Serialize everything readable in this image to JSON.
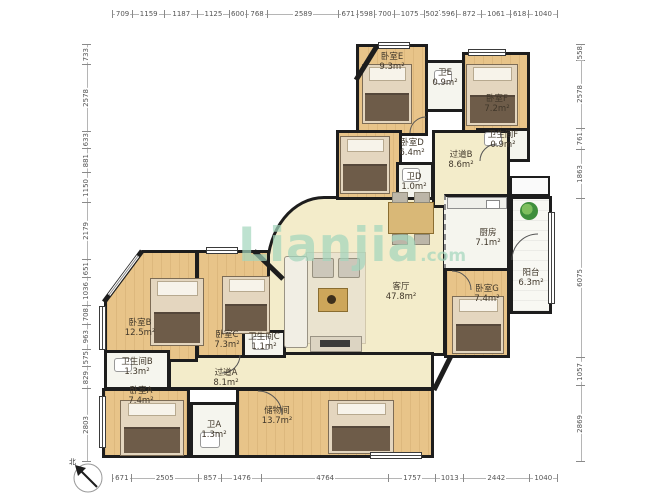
{
  "watermark": {
    "brand": "Lianjia",
    "suffix": ".com"
  },
  "compass": {
    "north_label": "北"
  },
  "colors": {
    "wall": "#1d1d1d",
    "wood_floor": "#e8c489",
    "public_floor": "#f3ecca",
    "wet_room_floor": "#f5f5ee",
    "watermark_green": "#a3d6bd"
  },
  "dimensions_mm": {
    "top": [
      709,
      1159,
      1187,
      1125,
      600,
      768,
      2589,
      671,
      598,
      700,
      1075,
      502,
      596,
      872,
      1061,
      618,
      1040
    ],
    "bottom": [
      671,
      2505,
      857,
      1476,
      4764,
      1757,
      1013,
      2442,
      1040
    ],
    "left": [
      733,
      2578,
      633,
      881,
      1150,
      2179,
      651,
      1036,
      708,
      963,
      575,
      829,
      2803
    ],
    "right": [
      558,
      2578,
      761,
      1863,
      6075,
      1057,
      2869
    ]
  },
  "rooms": {
    "bedroom_e": {
      "name": "卧室E",
      "area": "9.3m²"
    },
    "toilet_e": {
      "name": "卫E",
      "area": "0.9m²"
    },
    "bedroom_f": {
      "name": "卧室F",
      "area": "7.2m²"
    },
    "bathroom_f": {
      "name": "卫生间F",
      "area": "0.9m²"
    },
    "bedroom_d": {
      "name": "卧室D",
      "area": "6.4m²"
    },
    "toilet_d": {
      "name": "卫D",
      "area": "1.0m²"
    },
    "hallway_b": {
      "name": "过道B",
      "area": "8.6m²"
    },
    "kitchen": {
      "name": "厨房",
      "area": "7.1m²"
    },
    "balcony": {
      "name": "阳台",
      "area": "6.3m²"
    },
    "bedroom_g": {
      "name": "卧室G",
      "area": "7.4m²"
    },
    "living_room": {
      "name": "客厅",
      "area": "47.8m²"
    },
    "bedroom_b": {
      "name": "卧室B",
      "area": "12.5m²"
    },
    "bedroom_c": {
      "name": "卧室C",
      "area": "7.3m²"
    },
    "bathroom_c": {
      "name": "卫生间C",
      "area": "1.1m²"
    },
    "bathroom_b": {
      "name": "卫生间B",
      "area": "1.3m²"
    },
    "hallway_a": {
      "name": "过道A",
      "area": "8.1m²"
    },
    "bedroom_a": {
      "name": "卧室A",
      "area": "7.4m²"
    },
    "toilet_a": {
      "name": "卫A",
      "area": "1.3m²"
    },
    "storage": {
      "name": "储物间",
      "area": "13.7m²"
    }
  }
}
